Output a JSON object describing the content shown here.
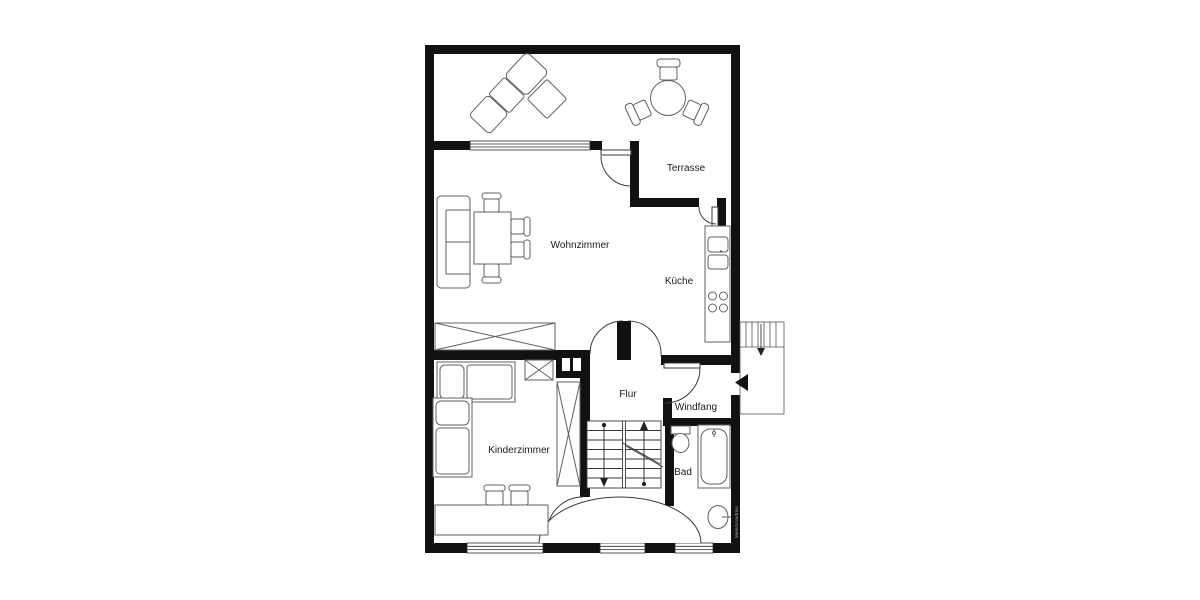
{
  "plan": {
    "type": "floor-plan",
    "rooms": [
      {
        "id": "terrasse",
        "label": "Terrasse"
      },
      {
        "id": "wohnzimmer",
        "label": "Wohnzimmer"
      },
      {
        "id": "kueche",
        "label": "Küche"
      },
      {
        "id": "flur",
        "label": "Flur"
      },
      {
        "id": "windfang",
        "label": "Windfang"
      },
      {
        "id": "kinderzimmer",
        "label": "Kinderzimmer"
      },
      {
        "id": "bad",
        "label": "Bad"
      }
    ],
    "watermark": "MeinGrundriss",
    "colors": {
      "background": "#ffffff",
      "wall": "#111111",
      "furniture": "#616161",
      "door": "#3a3a3a",
      "label": "#1c1c1c",
      "watermark": "#aaaaaa"
    }
  }
}
